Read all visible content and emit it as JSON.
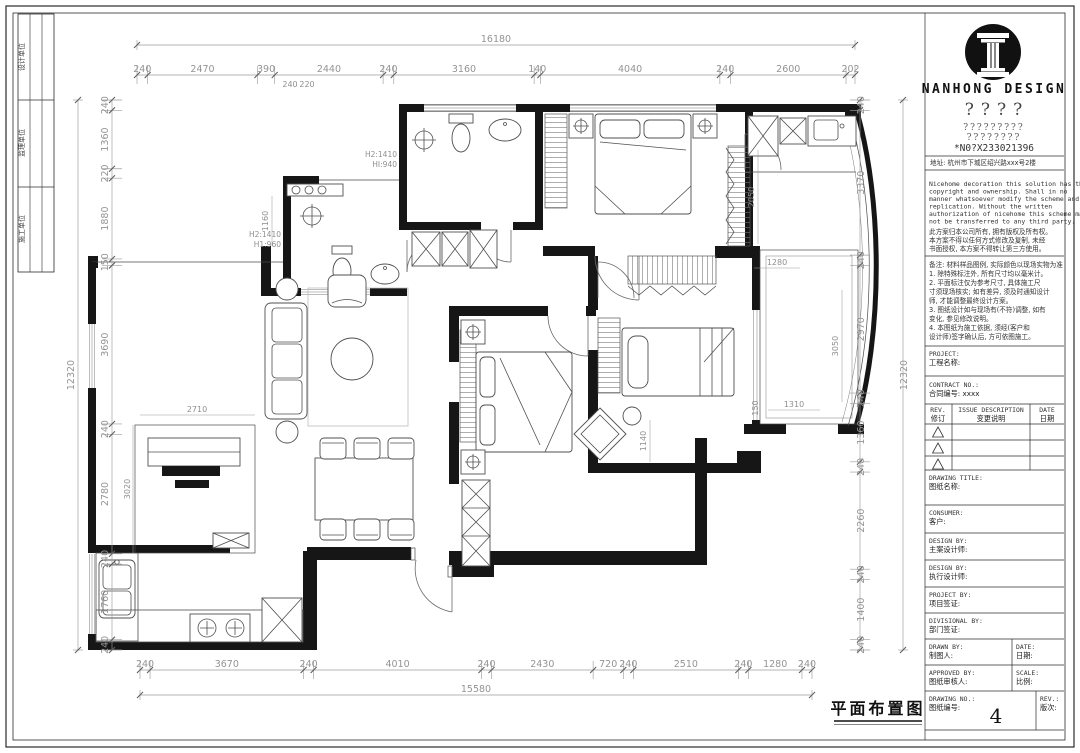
{
  "page": {
    "drawing_label": "平面布置图",
    "page_number": "4"
  },
  "side_strip": {
    "cells": [
      "设计单位",
      "监理单位",
      "施工单位"
    ]
  },
  "dims": {
    "top": {
      "overall": "16180",
      "segments": [
        "240",
        "2470",
        "390",
        "2440",
        "240",
        "3160",
        "140",
        "4040",
        "240",
        "2600",
        "202"
      ],
      "sub": [
        "240",
        "220"
      ]
    },
    "left": {
      "overall": "12320",
      "segments": [
        "240",
        "1360",
        "220",
        "1880",
        "150",
        "3690",
        "240",
        "2780",
        "240",
        "1760",
        "240"
      ]
    },
    "right": {
      "overall": "12320",
      "segments": [
        "240",
        "3370",
        "240",
        "2970",
        "240",
        "1360",
        "240",
        "2260",
        "240",
        "1400",
        "240"
      ]
    },
    "bottom": {
      "overall": "15580",
      "segments": [
        "240",
        "3670",
        "240",
        "4010",
        "240",
        "2430",
        "720",
        "240",
        "2510",
        "240",
        "1280",
        "240"
      ]
    }
  },
  "plan": {
    "annotations": {
      "bath_top_h2": "H2:1410",
      "bath_top_h1": "HI:940",
      "bath_left_h2": "H2:1410",
      "bath_left_h1": "H1:960",
      "a1160": "1160",
      "a2710": "2710",
      "a3020": "3020",
      "a2050": "2050",
      "a1280": "1280",
      "a3050": "3050",
      "a1310": "1310",
      "a150": "150",
      "a1140": "1140"
    }
  },
  "title_block": {
    "brand": "NANHONG DESIGN",
    "q1": "????",
    "q2": "?????????",
    "q3": "????????",
    "phone": "*N0?X233021396",
    "address": "地址: 杭州市下城区绍兴路xxx号2楼",
    "en_lines": [
      "Nicehome decoration this solution has the",
      "copyright and ownership. Shall in no",
      "manner whatsoever modify the scheme and",
      "replication. Without the written",
      "authorization of nicehome this scheme may",
      "not be transferred to any third party."
    ],
    "cn_lines": [
      "此方案归本公司所有, 拥有版权及所有权。",
      "本方案不得以任何方式修改及复制, 未经",
      "书面授权, 本方案不得转让第三方使用。"
    ],
    "notes_lines": [
      "备注: 材料样品图例, 实际颜色以现场实物为准",
      "1. 除特殊标注外, 所有尺寸均以毫米计。",
      "2. 平面标注仅为参考尺寸, 具体施工尺",
      "寸须现场核实; 如有差异, 须及时通知设计",
      "师, 才能调整最终设计方案。",
      "3. 图纸设计如与现场有(不符)调整, 如有",
      "变化, 参见修改说明。",
      "4. 本图纸为施工依据, 须经(客户和",
      "设计师)签字确认后, 方可依图施工。"
    ],
    "project_label": "PROJECT:",
    "project_cn": "工程名称:",
    "contract_label": "CONTRACT NO.:",
    "contract_cn": "合同编号: xxxx",
    "rev_table": {
      "col1_en": "REV.",
      "col1_cn": "修订",
      "col2_en": "ISSUE DESCRIPTION",
      "col2_cn": "变更说明",
      "col3_en": "DATE",
      "col3_cn": "日期"
    },
    "drawing_title_label": "DRAWING TITLE:",
    "drawing_title_cn": "图纸名称:",
    "consumer_label": "CONSUMER:",
    "consumer_cn": "客户:",
    "design1_label": "DESIGN BY:",
    "design1_cn": "主案设计师:",
    "design2_label": "DESIGN BY:",
    "design2_cn": "执行设计师:",
    "projectby_label": "PROJECT BY:",
    "projectby_cn": "项目签证:",
    "divisional_label": "DIVISIONAL BY:",
    "divisional_cn": "部门签证:",
    "drawn_label": "DRAWN BY:",
    "drawn_cn": "制图人:",
    "date_label": "DATE:",
    "date_cn": "日期:",
    "approved_label": "APPROVED BY:",
    "approved_cn": "图纸审核人:",
    "scale_label": "SCALE:",
    "scale_cn": "比例:",
    "drawingno_label": "DRAWING NO.:",
    "drawingno_cn": "图纸编号:",
    "drawing_no": "4",
    "rev_label": "REV.:",
    "rev_cn": "版次:"
  }
}
